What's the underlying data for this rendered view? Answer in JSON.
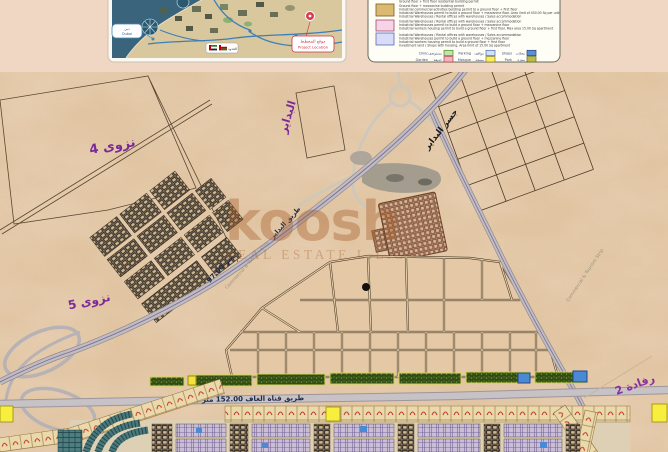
{
  "top": {
    "inset": {
      "pin_label_line1": "موقع المخطط",
      "pin_label_line2": "Project Location",
      "callout_line1": "دبي",
      "callout_line2": "Dubai",
      "border_label": "الحدود"
    },
    "legend": {
      "intro_line": "Ground floor + first floor residential building permit",
      "blocks": [
        {
          "color": "#dcb971",
          "border": "#7a5c1e",
          "lines": [
            "Ground floor + mezzanine building permit",
            "Industrial commercial activities building permit to a ground floor + first floor",
            "Industrial Warehouses permit to build a ground floor + mezzanine floor. Area limit of 450.00 Sq per unit",
            "Industrial Warehouses / Rental offices with warehouses / Sales accommodation"
          ]
        },
        {
          "color": "#f6d3e6",
          "border": "#a04a6a",
          "lines": [
            "Industrial Warehouses / Rental offices with warehouses / Sales accommodation",
            "Industrial Warehouses permit to build a ground floor + mezzanine floor",
            "Industrial workers housing permit to build a ground floor + first floor. Max area 15.00 Sq apartment"
          ]
        },
        {
          "color": "#d9dcf8",
          "border": "#5a6ab8",
          "lines": [
            "Industrial Warehouses / Rental offices with warehouses / Sales accommodation",
            "Industrial Warehouses permit to build a ground floor + mezzanine floor",
            "Industrial workers housing permit to build a ground floor + first floor",
            "Investment land / Shops with housing. Area limit of 15.00 Sq apartment"
          ]
        }
      ],
      "items": [
        {
          "label_en": "Clinic",
          "label_ar": "مستوصف",
          "color": "#c3e3a9",
          "border": "#4a8a2a"
        },
        {
          "label_en": "Parking",
          "label_ar": "مواقف",
          "color": "#cfe2f5",
          "border": "#4a6ab8"
        },
        {
          "label_en": "Shops",
          "label_ar": "محلات",
          "color": "#5b8fd4",
          "border": "#26467e"
        },
        {
          "label_en": "Garden",
          "label_ar": "حديقة",
          "color": "#f0b4be",
          "border": "#b83a4a"
        },
        {
          "label_en": "Mosque",
          "label_ar": "مسجد",
          "color": "#f7ef5a",
          "border": "#8a7a1a"
        },
        {
          "label_en": "Park",
          "label_ar": "منتزه",
          "color": "#b9bd3f",
          "border": "#6a6a1a"
        }
      ]
    }
  },
  "map": {
    "labels": {
      "nizwa4": "نزوى 4",
      "nizwa5": "نزوى 5",
      "badayer": "البداير",
      "bridge": "جسر البداير",
      "rafadah2": "رفادة 2",
      "road_a_name": "طريق البداير",
      "road_a_width": "97.00 متر",
      "road_c": "طريق  قناة  الغاف   152.00  متر",
      "note_1": "Commercial & Tourism Strip",
      "note_2": "Commercial & Tourism Strip"
    },
    "watermark": {
      "line1": "koosh",
      "line2": "REAL ESTATE L.L.C"
    }
  }
}
